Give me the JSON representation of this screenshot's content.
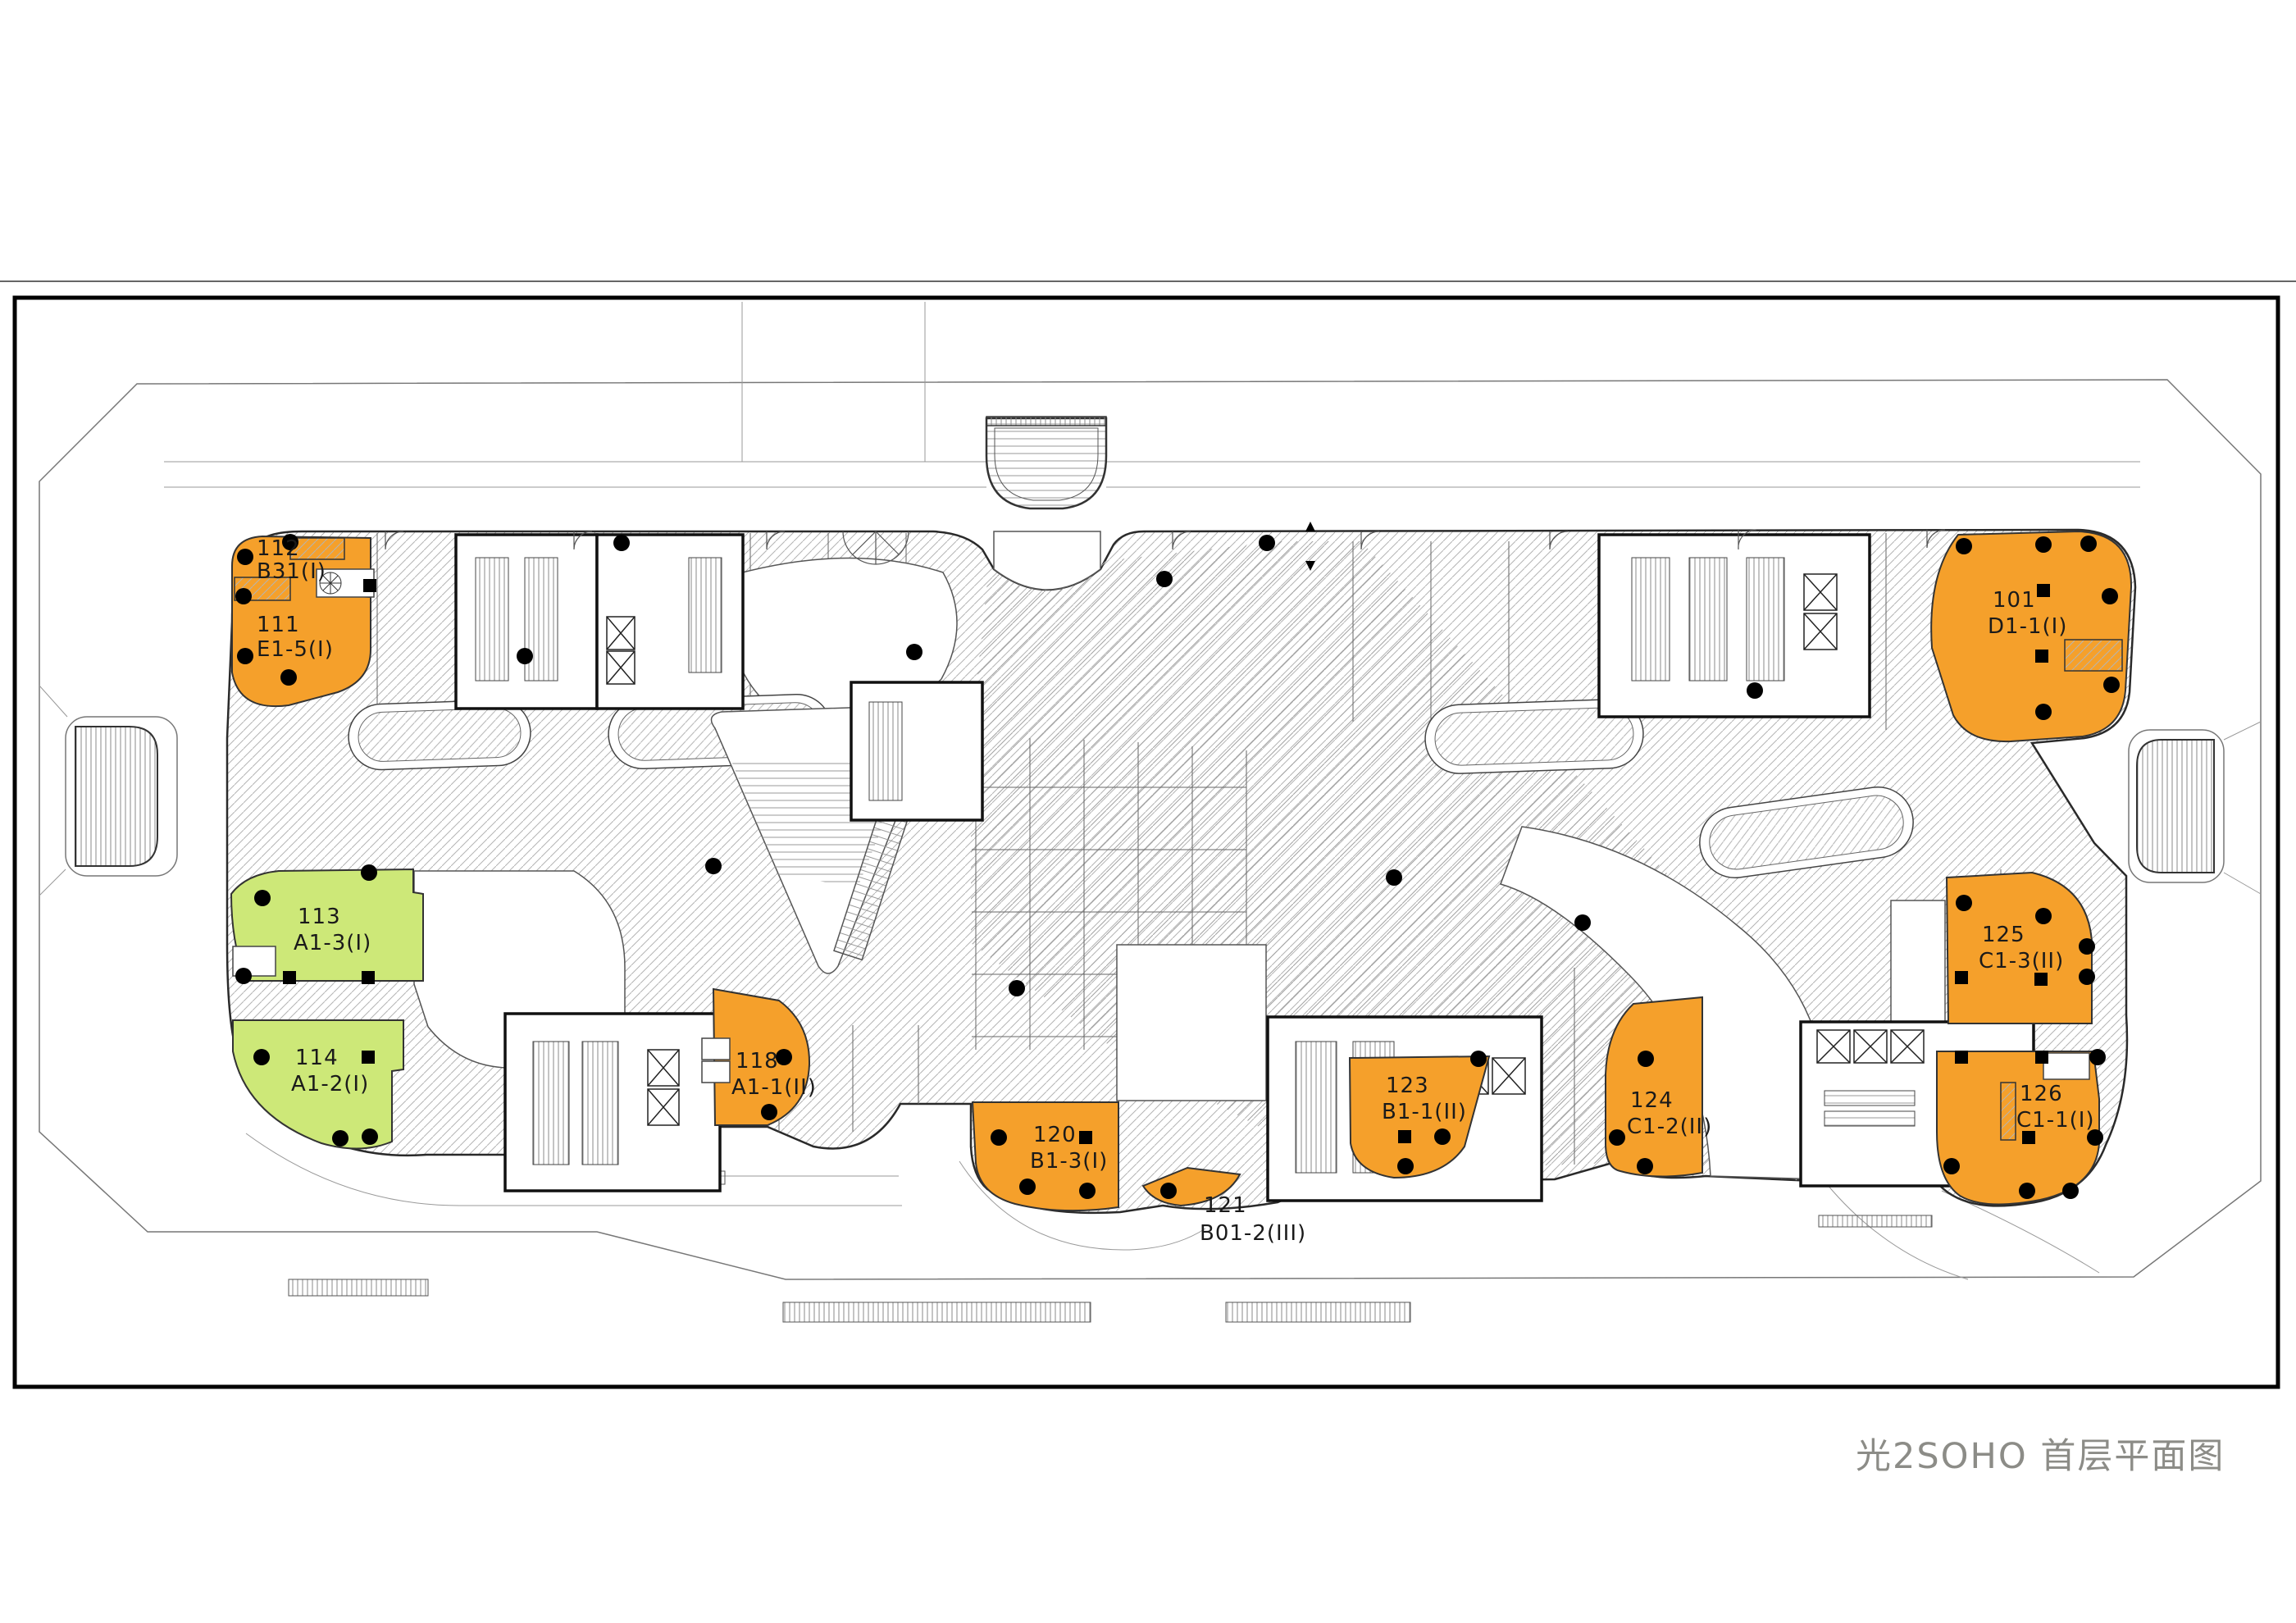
{
  "title": "光2SOHO 首层平面图",
  "colors": {
    "orange": "#F5A02B",
    "green": "#CDE878",
    "label": "#1a1a1a",
    "title_color": "#8C8C87",
    "hatch": "#b4b4b4",
    "wall": "#111111",
    "frame": "#000000"
  },
  "units": [
    {
      "number": "112",
      "code": "B31(I)",
      "color": "orange"
    },
    {
      "number": "111",
      "code": "E1-5(I)",
      "color": "orange"
    },
    {
      "number": "101",
      "code": "D1-1(I)",
      "color": "orange"
    },
    {
      "number": "113",
      "code": "A1-3(I)",
      "color": "green"
    },
    {
      "number": "114",
      "code": "A1-2(I)",
      "color": "green"
    },
    {
      "number": "118",
      "code": "A1-1(II)",
      "color": "orange"
    },
    {
      "number": "120",
      "code": "B1-3(I)",
      "color": "orange"
    },
    {
      "number": "121",
      "code": "B01-2(III)",
      "color": "none"
    },
    {
      "number": "123",
      "code": "B1-1(II)",
      "color": "orange"
    },
    {
      "number": "124",
      "code": "C1-2(II)",
      "color": "orange"
    },
    {
      "number": "125",
      "code": "C1-3(II)",
      "color": "orange"
    },
    {
      "number": "126",
      "code": "C1-1(I)",
      "color": "orange"
    }
  ]
}
